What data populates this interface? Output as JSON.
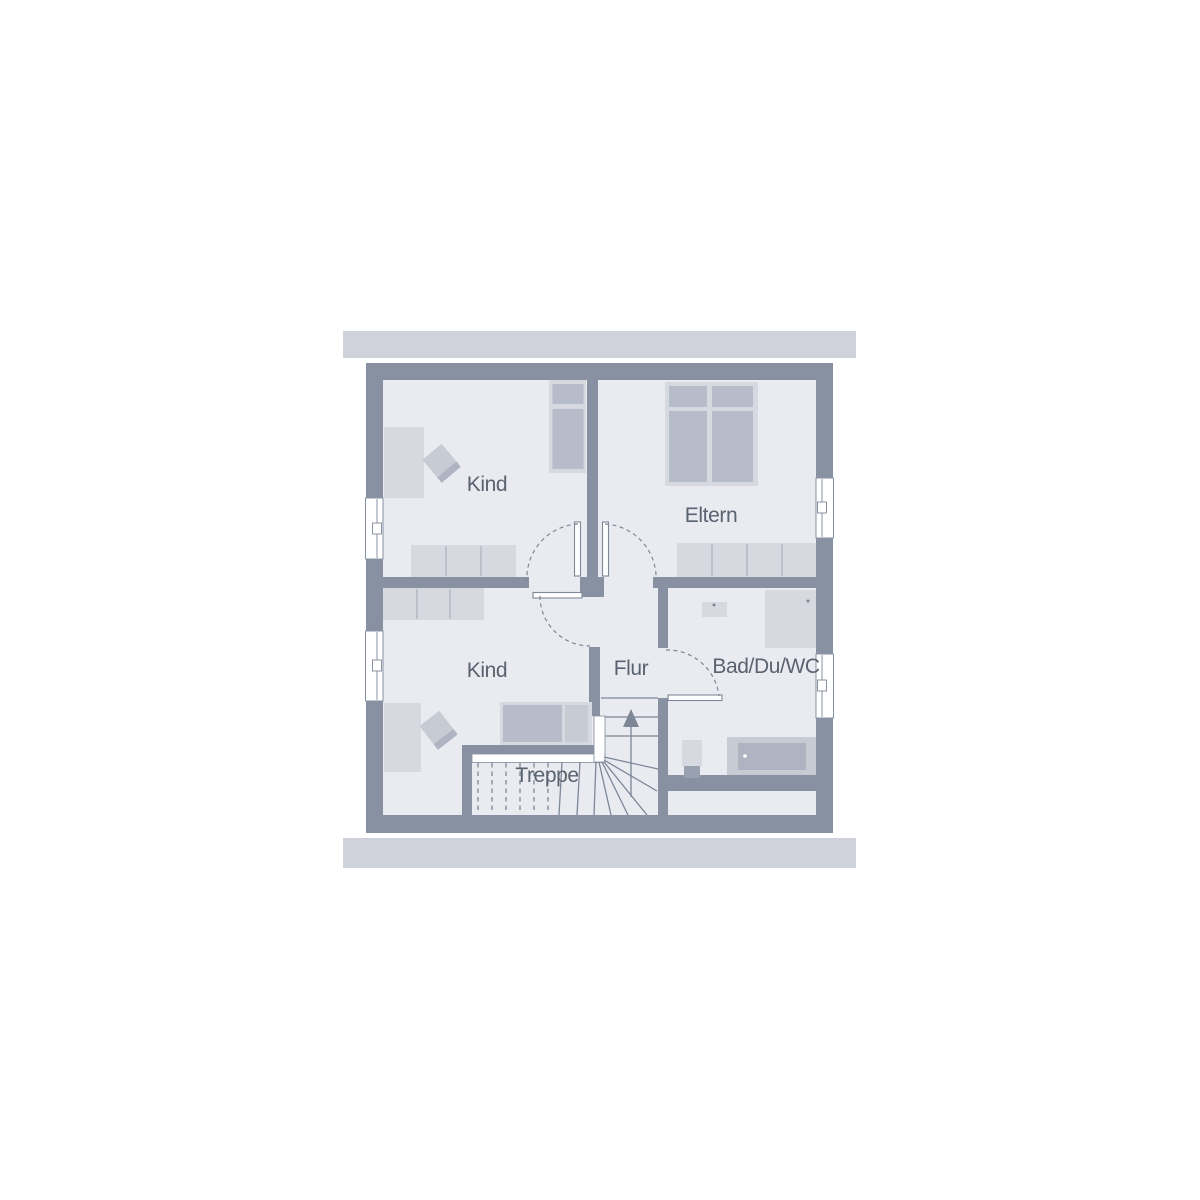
{
  "labels": {
    "kind_top": "Kind",
    "eltern": "Eltern",
    "kind_bottom": "Kind",
    "flur": "Flur",
    "bad": "Bad/Du/WC",
    "treppe": "Treppe"
  },
  "colors": {
    "wall": "#8891a2",
    "floor": "#e9ebf0",
    "overhang_bar": "#cfd2da",
    "furniture_light": "#d6d9e0",
    "furniture_mid": "#c7cbd4",
    "furniture_dark": "#b6bcc9",
    "fixture_inner": "#aeb4c1",
    "toilet_dark": "#99a1b0",
    "plan_line": "#7d8798",
    "divider_line": "#aab0bd",
    "band_edge": "#8e96a6",
    "label_text": "#5a6270",
    "background": "#ffffff"
  }
}
